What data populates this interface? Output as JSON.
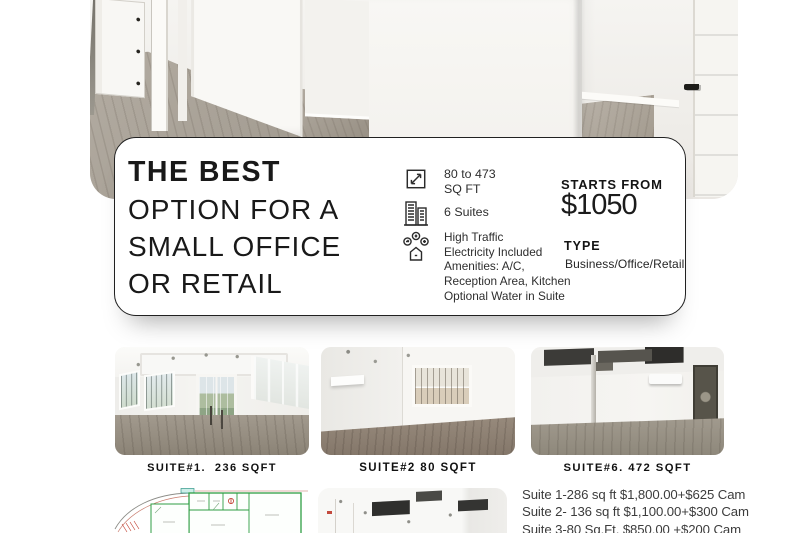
{
  "card": {
    "headline_lines": [
      "THE BEST",
      "OPTION FOR A",
      "SMALL OFFICE",
      "OR RETAIL"
    ],
    "size_feature": {
      "line1": "80 to 473",
      "line2": "SQ FT"
    },
    "suites_feature": "6 Suites",
    "amenities_lines": [
      "High Traffic",
      "Electricity Included",
      "Amenities: A/C,",
      "Reception Area, Kitchen",
      "Optional Water in Suite"
    ],
    "starts_from_label": "STARTS FROM",
    "price": "$1050",
    "type_label": "TYPE",
    "type_value": "Business/Office/Retail",
    "icons": {
      "size": "dimensions-arrow-square-icon",
      "suites": "buildings-icon",
      "amenities": "amenities-house-badges-icon"
    },
    "accent_color": "#1b1b1b",
    "border_color": "#212121"
  },
  "suites": [
    {
      "caption": "SUITE#1.  236 SQFT"
    },
    {
      "caption": "SUITE#2 80 SQFT"
    },
    {
      "caption": "SUITE#6. 472 SQFT"
    }
  ],
  "pricing_lines": [
    "Suite 1-286 sq ft $1,800.00+$625 Cam",
    "Suite 2- 136 sq ft $1,100.00+$300 Cam",
    "Suite 3-80 Sq.Ft. $850.00 +$200 Cam"
  ],
  "plan_colors": {
    "walls": "#2f9e44",
    "markers": "#c0392b"
  }
}
